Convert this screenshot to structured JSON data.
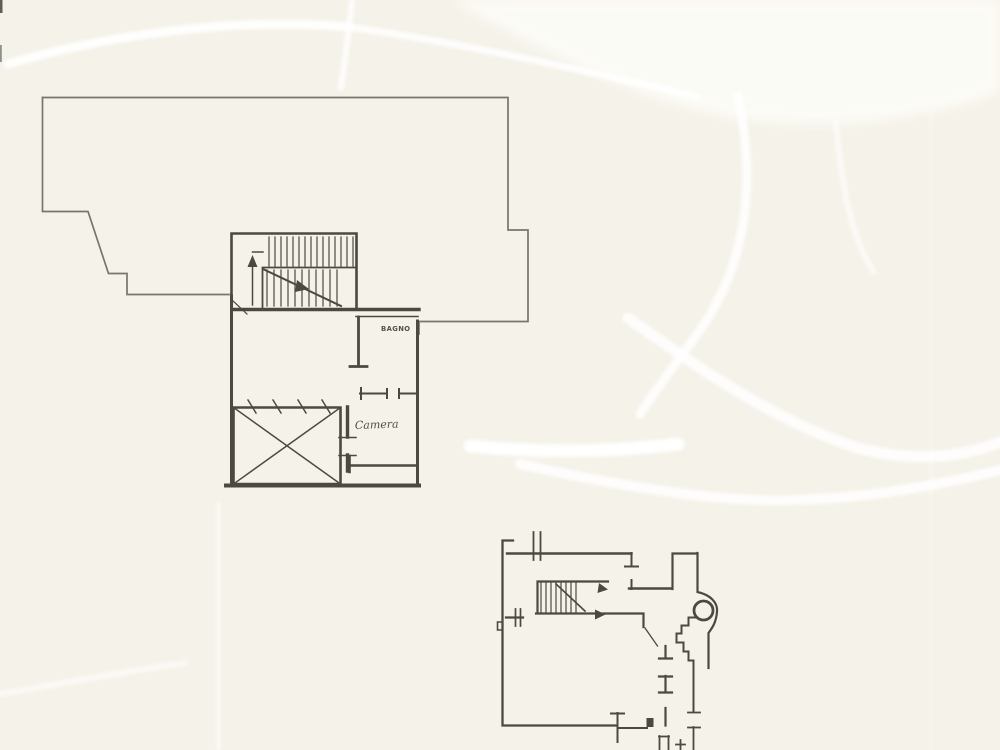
{
  "colors": {
    "paper": "#f5f2e9",
    "paper_bright": "#fdfdf8",
    "ink": "#4b4a43",
    "ink_light": "#77756c",
    "crease": "#ffffff",
    "edge_mark": "#4f4d47"
  },
  "upper_plan": {
    "labels": {
      "bathroom": "BAGNO",
      "bedroom": "Camera"
    }
  }
}
